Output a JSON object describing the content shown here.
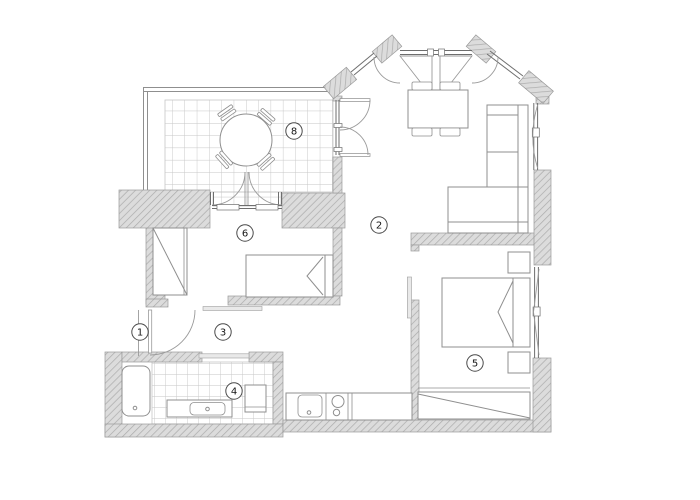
{
  "theme": {
    "wall_fill": "#dcdcdc",
    "hatch": "#ababab",
    "wall_line": "#9a9a9a",
    "line": "#6e6e6e",
    "furn": "#8f8f8f",
    "tile": "#c6c6c6",
    "door": "#9a9a9a",
    "label_text": "#141414"
  },
  "rooms": {
    "entry": {
      "number": "1"
    },
    "living": {
      "number": "2"
    },
    "hall": {
      "number": "3"
    },
    "bathroom": {
      "number": "4"
    },
    "bedroom": {
      "number": "5"
    },
    "small_bedroom": {
      "number": "6"
    },
    "terrace": {
      "number": "8"
    }
  }
}
